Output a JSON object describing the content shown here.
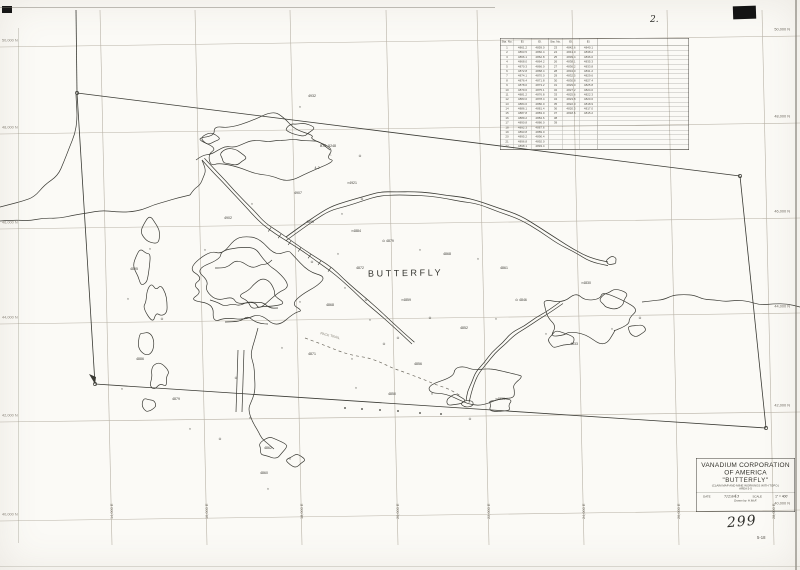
{
  "page": {
    "sheet_number": "2.",
    "map_number": "299",
    "sub_number": "5-18"
  },
  "map": {
    "center_label": "BUTTERFLY",
    "trail_label": "PACK TRAIL"
  },
  "colors": {
    "ink": "#3a3a34",
    "grid": "#b8b2a6",
    "paper": "#fbfaf6",
    "labels": "#6f6a60"
  },
  "title_block": {
    "line1": "VANADIUM CORPORATION",
    "line2": "OF AMERICA",
    "line3": "\"BUTTERFLY\"",
    "line4": "(CLAIM MAP AND MINE WORKINGS WITH TOPO.)",
    "line5": "AREA 5-5",
    "date_label": "DATE",
    "date_value": "7/29/43",
    "scale_label": "SCALE",
    "scale_value": "1\" = 400'",
    "drawn_by": "Drawn by: H.McF."
  },
  "survey_table": {
    "headers": [
      "Sta. No.",
      "El.",
      "El.",
      "Sta. No.",
      "El.",
      "El."
    ],
    "rows": [
      [
        "1",
        "4861.2",
        "4859.0",
        "23",
        "4842.6",
        "4840.1"
      ],
      [
        "2",
        "4863.5",
        "4860.4",
        "24",
        "4841.0",
        "4838.2"
      ],
      [
        "3",
        "4866.1",
        "4862.8",
        "25",
        "4839.4",
        "4836.0"
      ],
      [
        "4",
        "4868.0",
        "4864.2",
        "26",
        "4838.1",
        "4835.3"
      ],
      [
        "5",
        "4870.3",
        "4866.0",
        "27",
        "4836.2",
        "4833.8"
      ],
      [
        "6",
        "4872.8",
        "4868.4",
        "28",
        "4834.0",
        "4831.2"
      ],
      [
        "7",
        "4874.1",
        "4870.0",
        "29",
        "4832.5",
        "4829.6"
      ],
      [
        "8",
        "4876.4",
        "4871.8",
        "30",
        "4830.8",
        "4827.4"
      ],
      [
        "9",
        "4878.0",
        "4873.2",
        "31",
        "4829.0",
        "4825.8"
      ],
      [
        "10",
        "4879.6",
        "4875.1",
        "32",
        "4827.2",
        "4824.0"
      ],
      [
        "11",
        "4881.2",
        "4876.8",
        "33",
        "4825.6",
        "4822.3"
      ],
      [
        "12",
        "4883.0",
        "4878.4",
        "34",
        "4823.8",
        "4820.6"
      ],
      [
        "13",
        "4884.6",
        "4880.0",
        "35",
        "4822.0",
        "4818.9"
      ],
      [
        "14",
        "4886.1",
        "4881.4",
        "36",
        "4820.3",
        "4817.0"
      ],
      [
        "15",
        "4887.8",
        "4883.0",
        "37",
        "4818.6",
        "4815.2"
      ],
      [
        "16",
        "4889.2",
        "4884.6",
        "38",
        "",
        ""
      ],
      [
        "17",
        "4890.8",
        "4886.0",
        "39",
        "",
        ""
      ],
      [
        "18",
        "4892.3",
        "4887.6",
        "",
        "",
        ""
      ],
      [
        "19",
        "4893.8",
        "4889.0",
        "",
        "",
        ""
      ],
      [
        "20",
        "4895.2",
        "4890.4",
        "",
        "",
        ""
      ],
      [
        "21",
        "4896.8",
        "4892.0",
        "",
        "",
        ""
      ],
      [
        "22",
        "4898.1",
        "4893.4",
        "",
        "",
        ""
      ]
    ]
  },
  "grid": {
    "north_labels": [
      "50,000 N",
      "48,000 N",
      "46,000 N",
      "44,000 N",
      "42,000 N",
      "40,000 N"
    ],
    "east_labels": [
      "14,000 E",
      "16,000 E",
      "18,000 E",
      "20,000 E",
      "22,000 E",
      "24,000 E",
      "26,000 E",
      "28,000 E"
    ]
  },
  "annotations": [
    {
      "x": 328,
      "y": 146,
      "t": "B.M. 5248"
    },
    {
      "x": 330,
      "y": 154,
      "t": "△"
    },
    {
      "x": 317,
      "y": 168,
      "t": "4-2"
    },
    {
      "x": 352,
      "y": 183,
      "t": "×4921"
    },
    {
      "x": 298,
      "y": 193,
      "t": "4907"
    },
    {
      "x": 362,
      "y": 199,
      "t": "⊙"
    },
    {
      "x": 342,
      "y": 214,
      "t": "×"
    },
    {
      "x": 310,
      "y": 222,
      "t": "4890"
    },
    {
      "x": 356,
      "y": 231,
      "t": "×4884"
    },
    {
      "x": 388,
      "y": 241,
      "t": "⊙ 4879"
    },
    {
      "x": 420,
      "y": 250,
      "t": "×"
    },
    {
      "x": 447,
      "y": 254,
      "t": "4868"
    },
    {
      "x": 478,
      "y": 259,
      "t": "×"
    },
    {
      "x": 504,
      "y": 268,
      "t": "4861"
    },
    {
      "x": 338,
      "y": 254,
      "t": "×"
    },
    {
      "x": 312,
      "y": 262,
      "t": "⊙"
    },
    {
      "x": 360,
      "y": 268,
      "t": "4872"
    },
    {
      "x": 345,
      "y": 288,
      "t": "×"
    },
    {
      "x": 330,
      "y": 305,
      "t": "4868"
    },
    {
      "x": 300,
      "y": 302,
      "t": "×"
    },
    {
      "x": 366,
      "y": 300,
      "t": "⊙"
    },
    {
      "x": 406,
      "y": 300,
      "t": "×4859"
    },
    {
      "x": 430,
      "y": 318,
      "t": "⊙"
    },
    {
      "x": 464,
      "y": 328,
      "t": "4852"
    },
    {
      "x": 496,
      "y": 319,
      "t": "×"
    },
    {
      "x": 521,
      "y": 300,
      "t": "⊙ 4846"
    },
    {
      "x": 282,
      "y": 348,
      "t": "×"
    },
    {
      "x": 312,
      "y": 354,
      "t": "4871"
    },
    {
      "x": 352,
      "y": 359,
      "t": "×"
    },
    {
      "x": 384,
      "y": 344,
      "t": "⊙"
    },
    {
      "x": 418,
      "y": 364,
      "t": "4856"
    },
    {
      "x": 356,
      "y": 388,
      "t": "×"
    },
    {
      "x": 392,
      "y": 394,
      "t": "4850"
    },
    {
      "x": 432,
      "y": 394,
      "t": "×"
    },
    {
      "x": 470,
      "y": 419,
      "t": "⊙"
    },
    {
      "x": 500,
      "y": 399,
      "t": "×4839"
    },
    {
      "x": 250,
      "y": 418,
      "t": "×"
    },
    {
      "x": 268,
      "y": 448,
      "t": "4862"
    },
    {
      "x": 290,
      "y": 459,
      "t": "×"
    },
    {
      "x": 236,
      "y": 378,
      "t": "⊙"
    },
    {
      "x": 150,
      "y": 249,
      "t": "×"
    },
    {
      "x": 134,
      "y": 269,
      "t": "4895"
    },
    {
      "x": 128,
      "y": 299,
      "t": "×"
    },
    {
      "x": 162,
      "y": 319,
      "t": "⊙"
    },
    {
      "x": 140,
      "y": 359,
      "t": "4886"
    },
    {
      "x": 122,
      "y": 389,
      "t": "×"
    },
    {
      "x": 176,
      "y": 399,
      "t": "4879"
    },
    {
      "x": 190,
      "y": 429,
      "t": "×"
    },
    {
      "x": 220,
      "y": 439,
      "t": "⊙"
    },
    {
      "x": 264,
      "y": 473,
      "t": "4860"
    },
    {
      "x": 268,
      "y": 489,
      "t": "×"
    },
    {
      "x": 546,
      "y": 334,
      "t": "×"
    },
    {
      "x": 574,
      "y": 344,
      "t": "4833"
    },
    {
      "x": 612,
      "y": 329,
      "t": "×"
    },
    {
      "x": 640,
      "y": 318,
      "t": "⊙"
    },
    {
      "x": 586,
      "y": 283,
      "t": "×4830"
    },
    {
      "x": 360,
      "y": 156,
      "t": "⊙"
    },
    {
      "x": 300,
      "y": 107,
      "t": "×"
    },
    {
      "x": 312,
      "y": 96,
      "t": "4932"
    },
    {
      "x": 252,
      "y": 204,
      "t": "×"
    },
    {
      "x": 228,
      "y": 218,
      "t": "4902"
    },
    {
      "x": 205,
      "y": 250,
      "t": "×"
    },
    {
      "x": 370,
      "y": 320,
      "t": "×"
    },
    {
      "x": 398,
      "y": 338,
      "t": "⊙"
    },
    {
      "x": 330,
      "y": 336,
      "t": "PACK TRAIL",
      "r": 14,
      "f": 1
    }
  ]
}
